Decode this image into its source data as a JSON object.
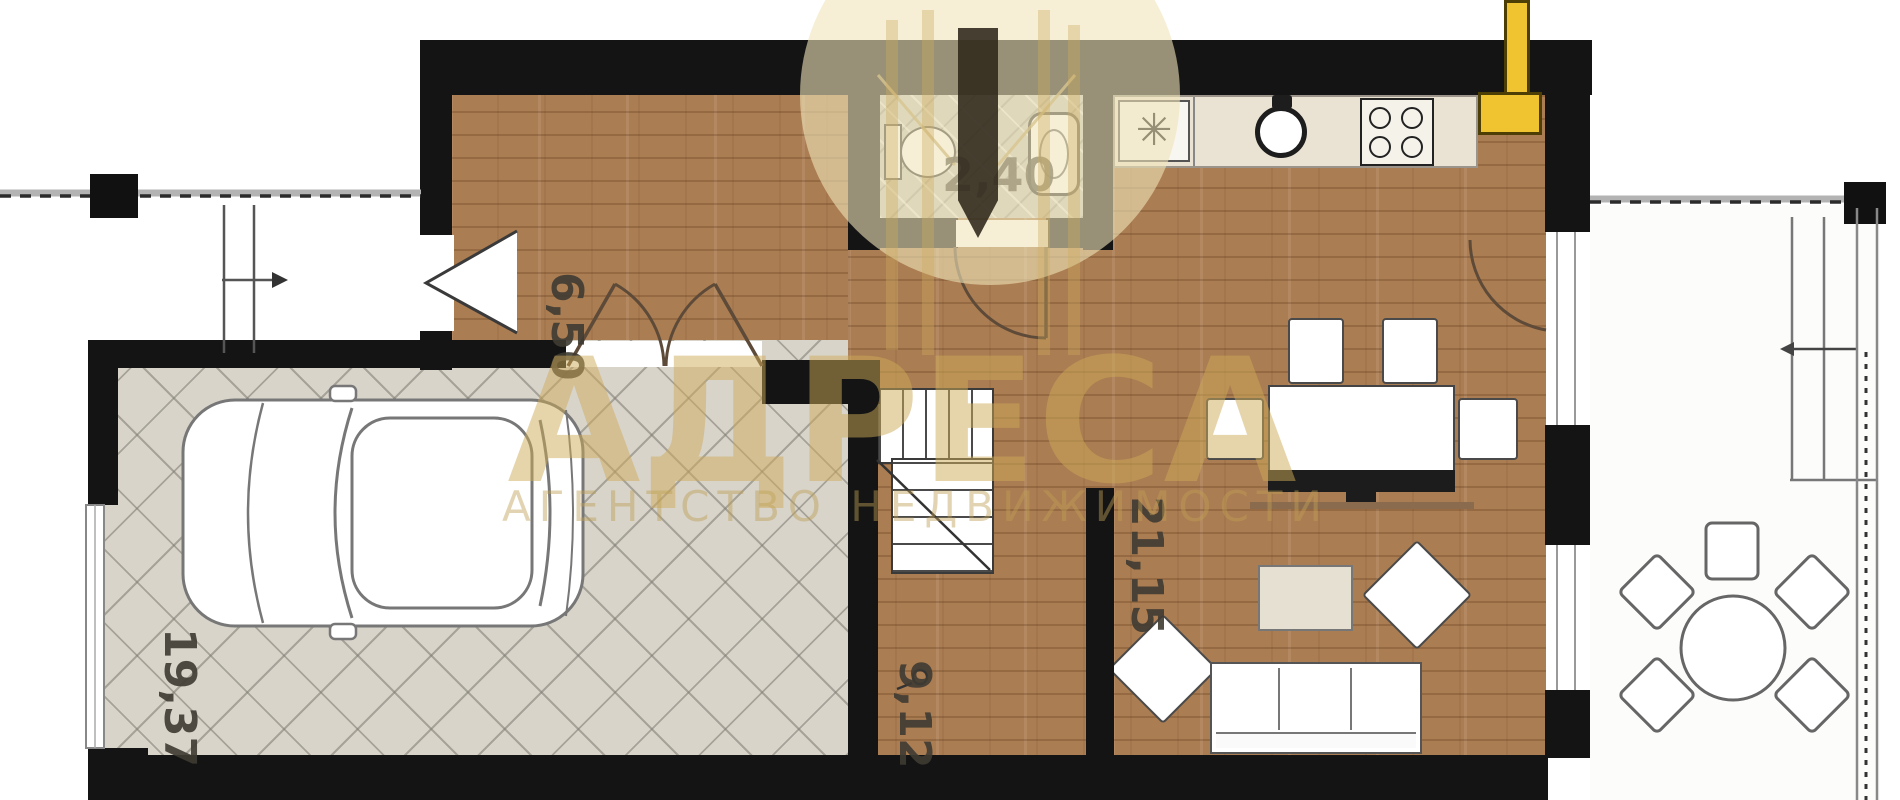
{
  "plan": {
    "title": "apartment-floor-plan",
    "room_labels": {
      "bathroom": "2,40",
      "hallway": "6,50",
      "living_kitchen": "21,15",
      "stair_hall": "9,12",
      "garage": "19,37"
    },
    "watermark": {
      "brand": "АДРЕСА",
      "tagline": "АГЕНТСТВО НЕДВИЖИМОСТИ"
    },
    "icons": {
      "boiler": "✳"
    },
    "colors": {
      "wall": "#141414",
      "wood_floor": "#ab7d52",
      "garage_floor": "#d8d4ca",
      "tile_floor": "#c9c6be",
      "counter": "#eae3d3",
      "accent_yellow": "#f0c431",
      "watermark_gold": "#d4af37"
    }
  }
}
